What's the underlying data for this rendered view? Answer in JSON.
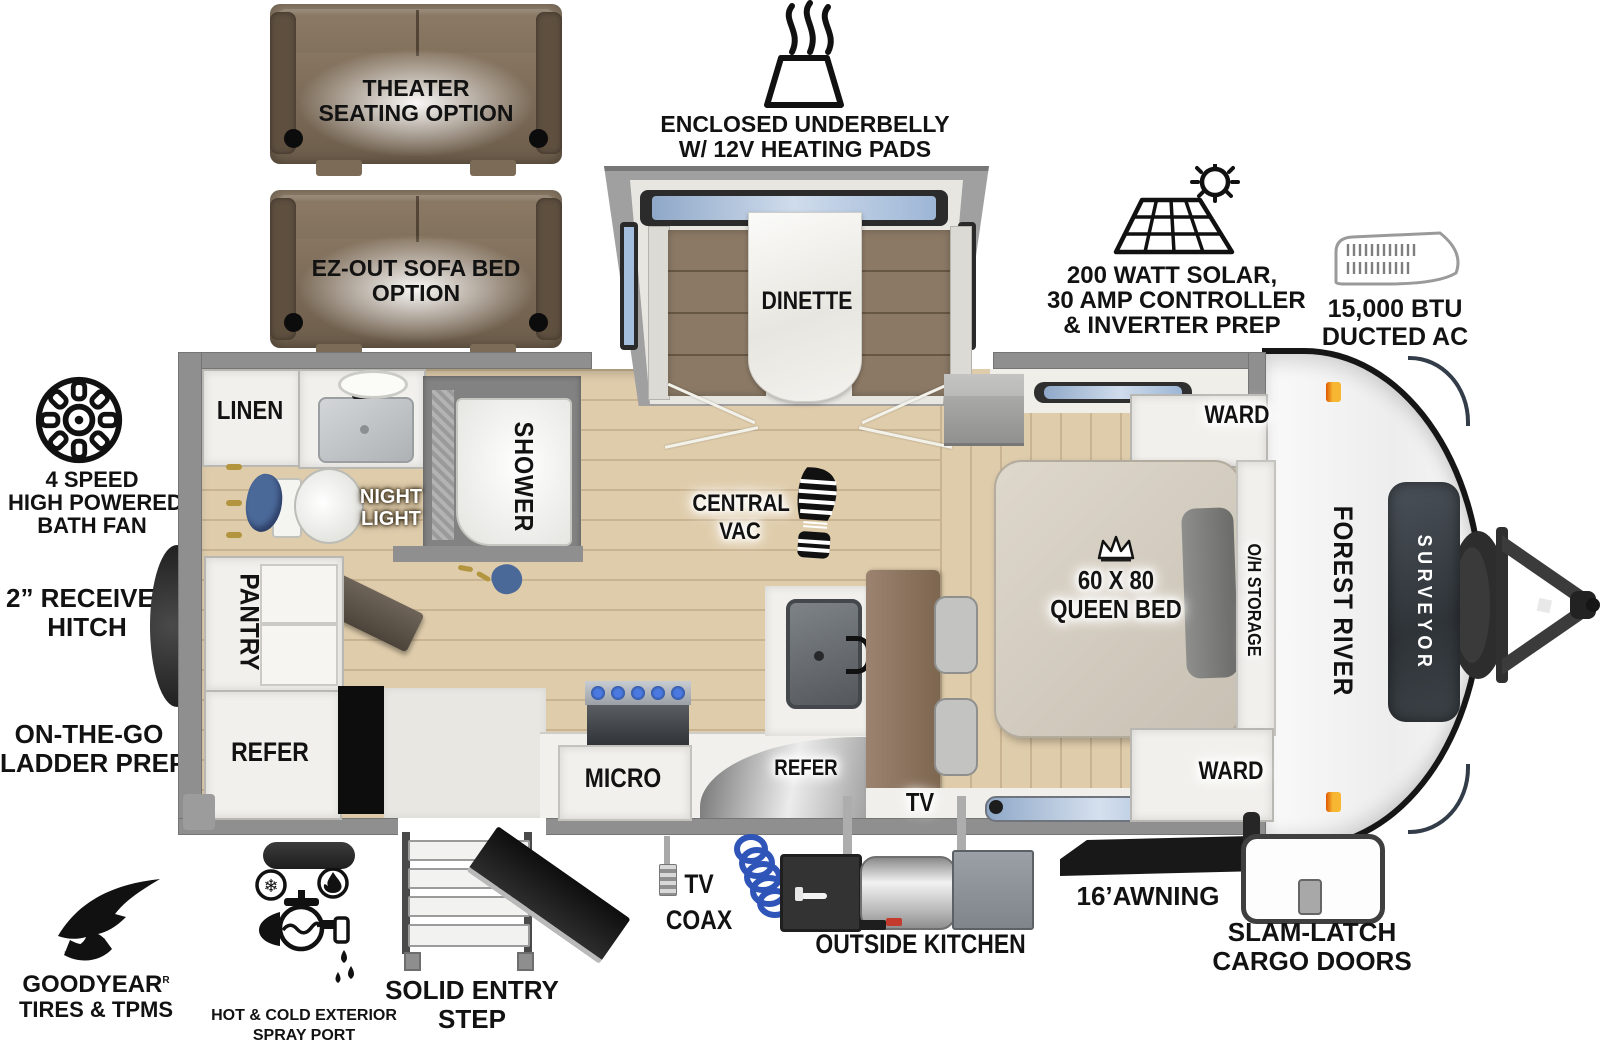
{
  "colors": {
    "wall": "#8f8f8f",
    "wood": "#dfccab",
    "cabinet": "#f1f0ec",
    "sofa_dark": "#6a594622",
    "bench": "#8b7965",
    "tv_wall": "#8d7460",
    "glass": "#a4bedd",
    "panel": "#3c4247",
    "amber": "#f2a13c",
    "hose_blue": "#2f55b8",
    "towel_blue": "#4a6898"
  },
  "options": {
    "theater_line1": "THEATER",
    "theater_line2": "SEATING OPTION",
    "sofabed_line1": "EZ-OUT SOFA BED",
    "sofabed_line2": "OPTION"
  },
  "callouts": {
    "underbelly_line1": "ENCLOSED UNDERBELLY",
    "underbelly_line2": "W/ 12V HEATING PADS",
    "solar_line1": "200 WATT SOLAR,",
    "solar_line2": "30 AMP CONTROLLER",
    "solar_line3": "& INVERTER PREP",
    "ac_line1": "15,000 BTU",
    "ac_line2": "DUCTED AC",
    "fan_line1": "4 SPEED",
    "fan_line2": "HIGH POWERED",
    "fan_line3": "BATH FAN",
    "receiver_line1": "2” RECEIVER",
    "receiver_line2": "HITCH",
    "ladder_line1": "ON-THE-GO",
    "ladder_line2": "LADDER PREP",
    "goodyear_line1": "GOODYEAR",
    "goodyear_reg": "R",
    "goodyear_line2": "TIRES & TPMS",
    "spray_line1": "HOT & COLD EXTERIOR",
    "spray_line2": "SPRAY PORT",
    "step_line1": "SOLID ENTRY",
    "step_line2": "STEP",
    "coax_line1": "TV",
    "coax_line2": "COAX",
    "outside_kitchen": "OUTSIDE KITCHEN",
    "awning": "16’AWNING",
    "cargo_line1": "SLAM-LATCH",
    "cargo_line2": "CARGO DOORS"
  },
  "rooms": {
    "dinette": "DINETTE",
    "linen": "LINEN",
    "shower": "SHOWER",
    "night_line1": "NIGHT",
    "night_line2": "LIGHT",
    "pantry": "PANTRY",
    "refer_rear": "REFER",
    "micro": "MICRO",
    "refer_kitchen": "REFER",
    "vac_line1": "CENTRAL",
    "vac_line2": "VAC",
    "tv": "TV",
    "ward_top": "WARD",
    "ward_bottom": "WARD",
    "bed_line1": "60 X 80",
    "bed_line2": "QUEEN BED",
    "oh_storage": "O/H STORAGE"
  },
  "branding": {
    "make": "FOREST RIVER",
    "model": "SURVEYOR"
  },
  "glyphs": {
    "snowflake": "❄"
  }
}
